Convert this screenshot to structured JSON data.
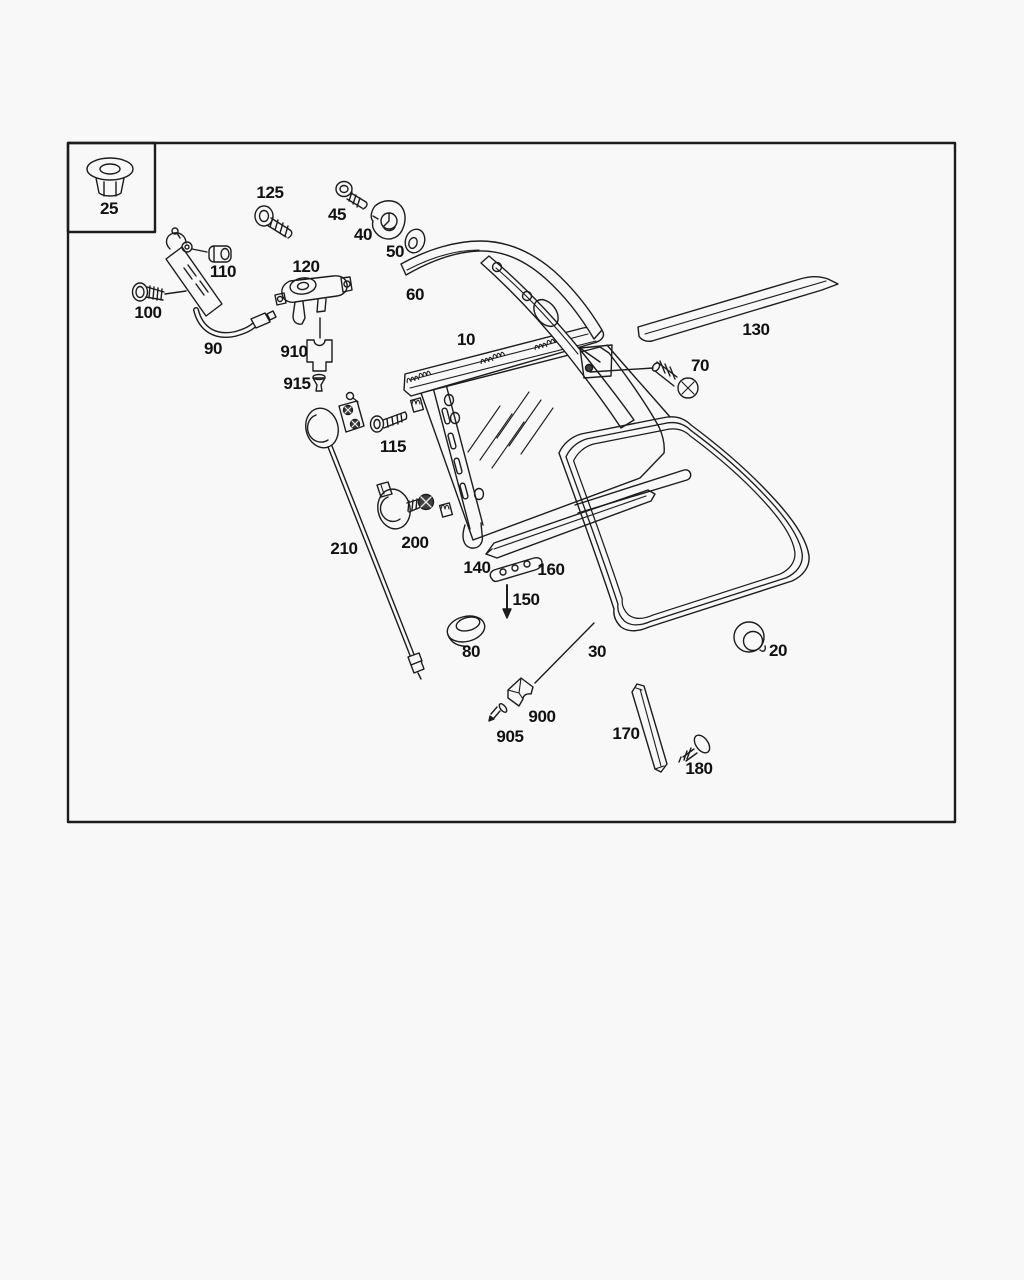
{
  "canvas": {
    "background": "#f8f8f8",
    "line_color": "#1c1c1c",
    "label_color": "#111111",
    "dark_fill": "#3f3f3f"
  },
  "parts": [
    {
      "id": "25",
      "label": "25",
      "name": "flanged-nut"
    },
    {
      "id": "125",
      "label": "125",
      "name": "bolt"
    },
    {
      "id": "45",
      "label": "45",
      "name": "screw"
    },
    {
      "id": "40",
      "label": "40",
      "name": "grommet-plate"
    },
    {
      "id": "50",
      "label": "50",
      "name": "washer"
    },
    {
      "id": "60",
      "label": "60",
      "name": "pillar-trim-strip"
    },
    {
      "id": "110",
      "label": "110",
      "name": "clamp-block"
    },
    {
      "id": "100",
      "label": "100",
      "name": "screw"
    },
    {
      "id": "120",
      "label": "120",
      "name": "actuator-motor"
    },
    {
      "id": "90",
      "label": "90",
      "name": "cable-with-bracket"
    },
    {
      "id": "910",
      "label": "910",
      "name": "mounting-clip"
    },
    {
      "id": "915",
      "label": "915",
      "name": "pin"
    },
    {
      "id": "10",
      "label": "10",
      "name": "quarter-window-frame"
    },
    {
      "id": "130",
      "label": "130",
      "name": "outer-trim-strip"
    },
    {
      "id": "70",
      "label": "70",
      "name": "phillips-screw"
    },
    {
      "id": "115",
      "label": "115",
      "name": "bolt"
    },
    {
      "id": "210",
      "label": "210",
      "name": "connecting-rod"
    },
    {
      "id": "200",
      "label": "200",
      "name": "grommet-with-screw"
    },
    {
      "id": "140",
      "label": "140",
      "name": "lower-rail-strip"
    },
    {
      "id": "160",
      "label": "160",
      "name": "clip-strip"
    },
    {
      "id": "150",
      "label": "150",
      "name": "insert-direction-arrow"
    },
    {
      "id": "80",
      "label": "80",
      "name": "oval-grommet"
    },
    {
      "id": "30",
      "label": "30",
      "name": "window-seal"
    },
    {
      "id": "20",
      "label": "20",
      "name": "round-plug"
    },
    {
      "id": "900",
      "label": "900",
      "name": "bracket-block"
    },
    {
      "id": "905",
      "label": "905",
      "name": "pin-screw"
    },
    {
      "id": "170",
      "label": "170",
      "name": "cover-strip"
    },
    {
      "id": "180",
      "label": "180",
      "name": "screw"
    }
  ]
}
